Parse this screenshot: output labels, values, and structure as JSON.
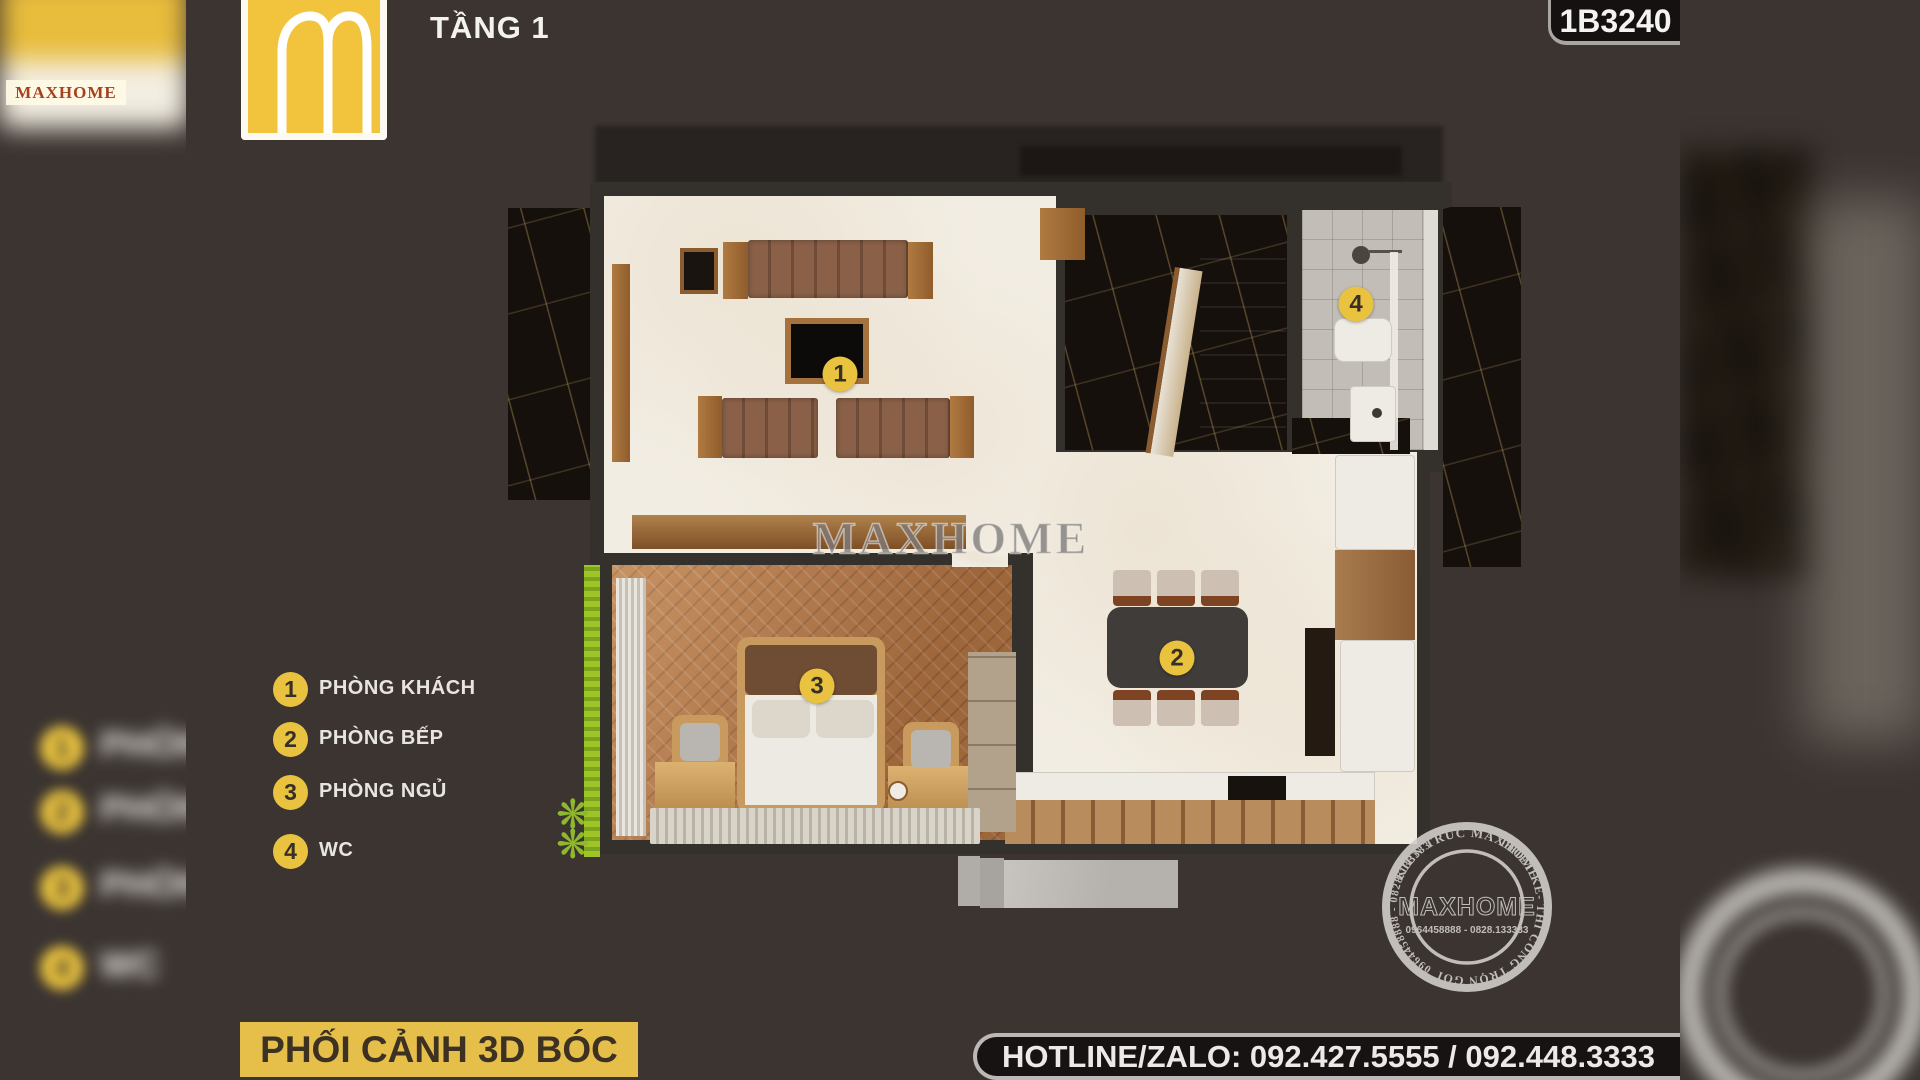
{
  "header": {
    "floor_label": "TẦNG 1",
    "code_badge": "1B3240"
  },
  "logo": {
    "name": "MAXHOME"
  },
  "legend": {
    "items": [
      {
        "num": "1",
        "label": "PHÒNG KHÁCH"
      },
      {
        "num": "2",
        "label": "PHÒNG BẾP"
      },
      {
        "num": "3",
        "label": "PHÒNG NGỦ"
      },
      {
        "num": "4",
        "label": "WC"
      }
    ]
  },
  "plan": {
    "markers": [
      {
        "num": "1",
        "room": "phong-khach",
        "x": 840,
        "y": 374
      },
      {
        "num": "2",
        "room": "phong-bep",
        "x": 1177,
        "y": 658
      },
      {
        "num": "3",
        "room": "phong-ngu",
        "x": 817,
        "y": 686
      },
      {
        "num": "4",
        "room": "wc",
        "x": 1356,
        "y": 304
      }
    ]
  },
  "watermark": {
    "text": "MAXHOME"
  },
  "stamp": {
    "arc_top": "KIẾN TRÚC MAXHOME",
    "arc_right": "THIẾT KẾ- THI CÔNG TRỌN GÓI",
    "arc_left": "0964458888 - 0828.133333",
    "center_name": "MAXHOME",
    "center_phone": "0964458888 - 0828.133333"
  },
  "footer": {
    "caption": "PHỐI CẢNH 3D BÓC MÁI",
    "hotline": "HOTLINE/ZALO: 092.427.5555 / 092.448.3333"
  },
  "colors": {
    "background": "#3b3431",
    "accent_yellow": "#e9c23f",
    "banner_yellow": "#e6bf4b",
    "badge_black": "#151110",
    "legend_text": "#e8e5e1",
    "floor_cream": "#f2ede3",
    "floor_wood": "#b5794a",
    "marble_dark": "#15100c",
    "wc_tile": "#c2beb7"
  }
}
